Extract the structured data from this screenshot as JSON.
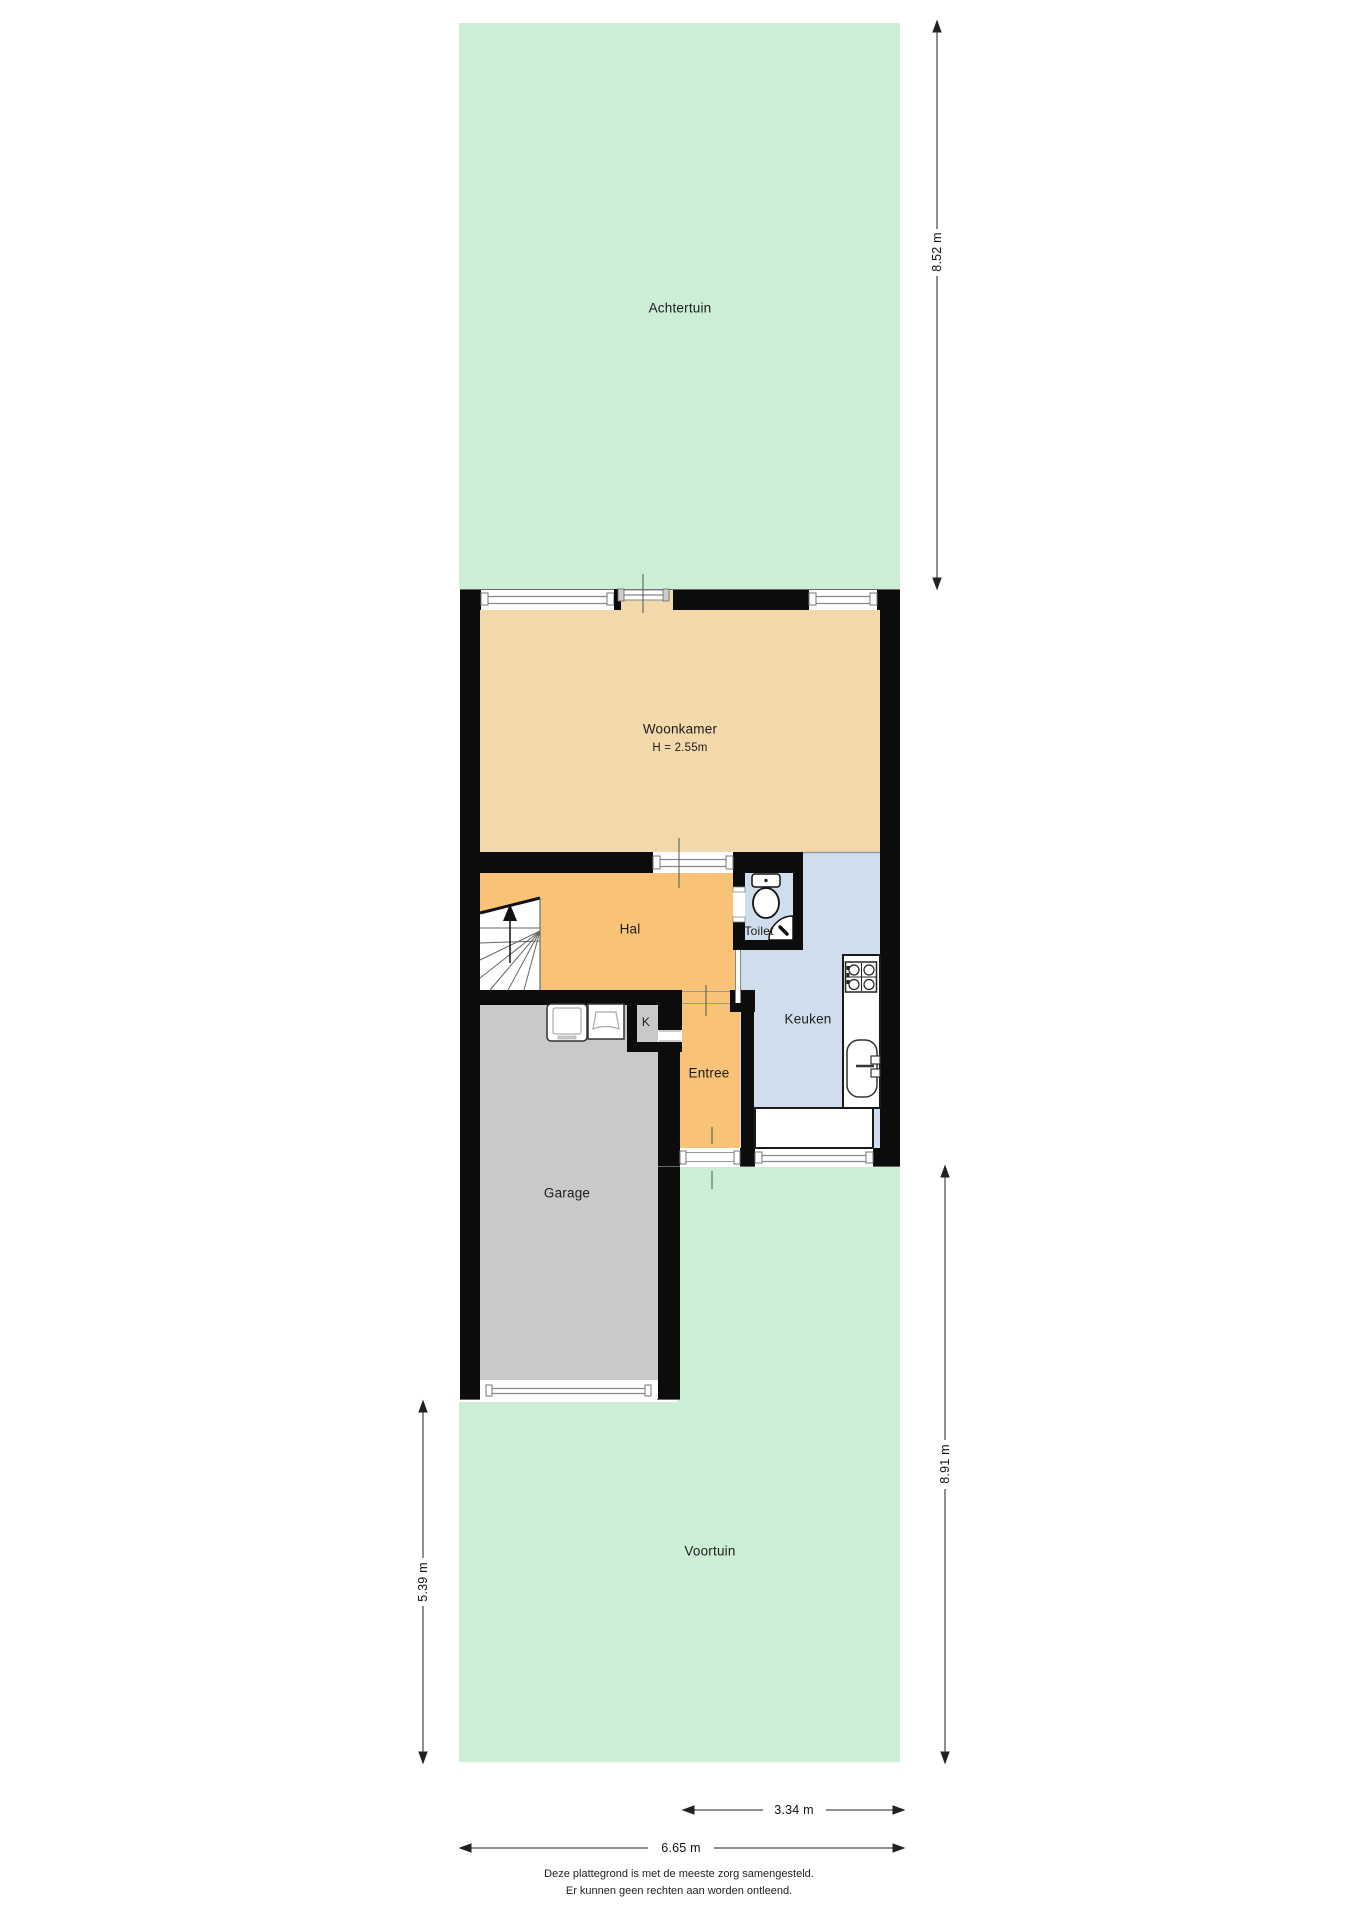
{
  "rooms": {
    "achtertuin": {
      "label": "Achtertuin"
    },
    "woonkamer": {
      "label": "Woonkamer",
      "height_note": "H = 2.55m"
    },
    "hal": {
      "label": "Hal"
    },
    "toilet": {
      "label": "Toilet"
    },
    "keuken": {
      "label": "Keuken"
    },
    "kast": {
      "label": "K"
    },
    "entree": {
      "label": "Entree"
    },
    "garage": {
      "label": "Garage"
    },
    "voortuin": {
      "label": "Voortuin"
    }
  },
  "dimensions": {
    "achtertuin_depth": {
      "label": "8.52 m"
    },
    "voortuin_right_depth": {
      "label": "8.91 m"
    },
    "voortuin_left_depth": {
      "label": "5.39 m"
    },
    "entrance_width": {
      "label": "3.34 m"
    },
    "total_width": {
      "label": "6.65 m"
    }
  },
  "footer": {
    "line1": "Deze plattegrond is met de meeste zorg samengesteld.",
    "line2": "Er kunnen geen rechten aan worden ontleend."
  },
  "colors": {
    "page": "#ffffff",
    "garden": "#cbeed5",
    "living": "#f2d8ab",
    "hall": "#f8c377",
    "kitchen": "#cfddec",
    "garage": "#c9c9c9",
    "wall": "#0c0c0c",
    "frame": "#888888",
    "dimline": "#222222"
  }
}
